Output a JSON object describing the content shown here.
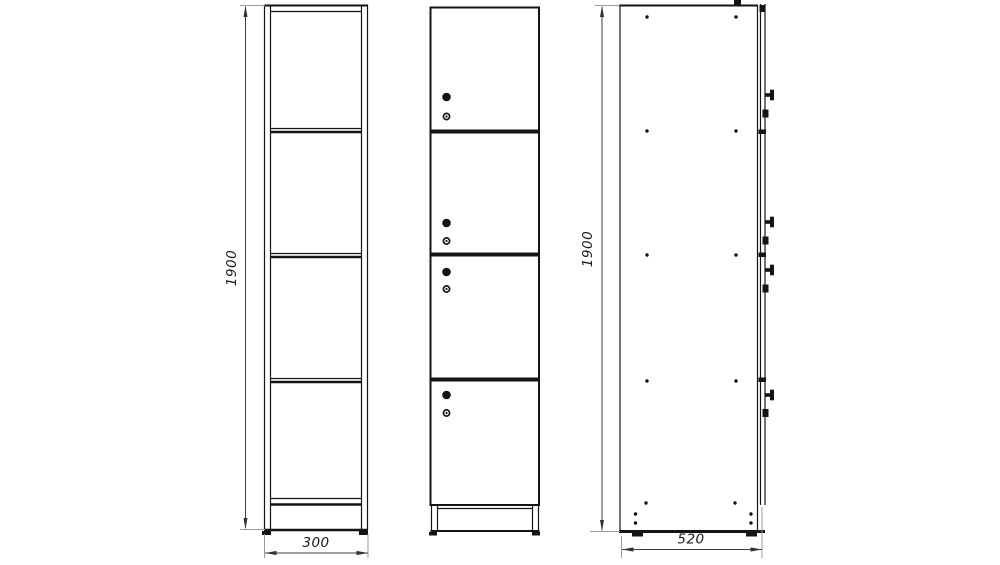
{
  "drawing": {
    "background_color": "#ffffff",
    "line_color": "#141414",
    "dimension_line_color": "#3d3d3d",
    "extension_line_color": "#9a9a9a",
    "text_color": "#1c1c1c",
    "dimensions": {
      "front_height": "1900",
      "front_width": "300",
      "side_height": "1900",
      "side_depth": "520"
    },
    "front_view": {
      "shelves": 3,
      "compartments": 4
    },
    "door_view": {
      "doors": 4,
      "knobs_per_door": 1,
      "locks_per_door": 1
    },
    "side_view": {
      "screw_columns": 2,
      "screw_rows": 5,
      "plinth_screws": 4
    }
  }
}
